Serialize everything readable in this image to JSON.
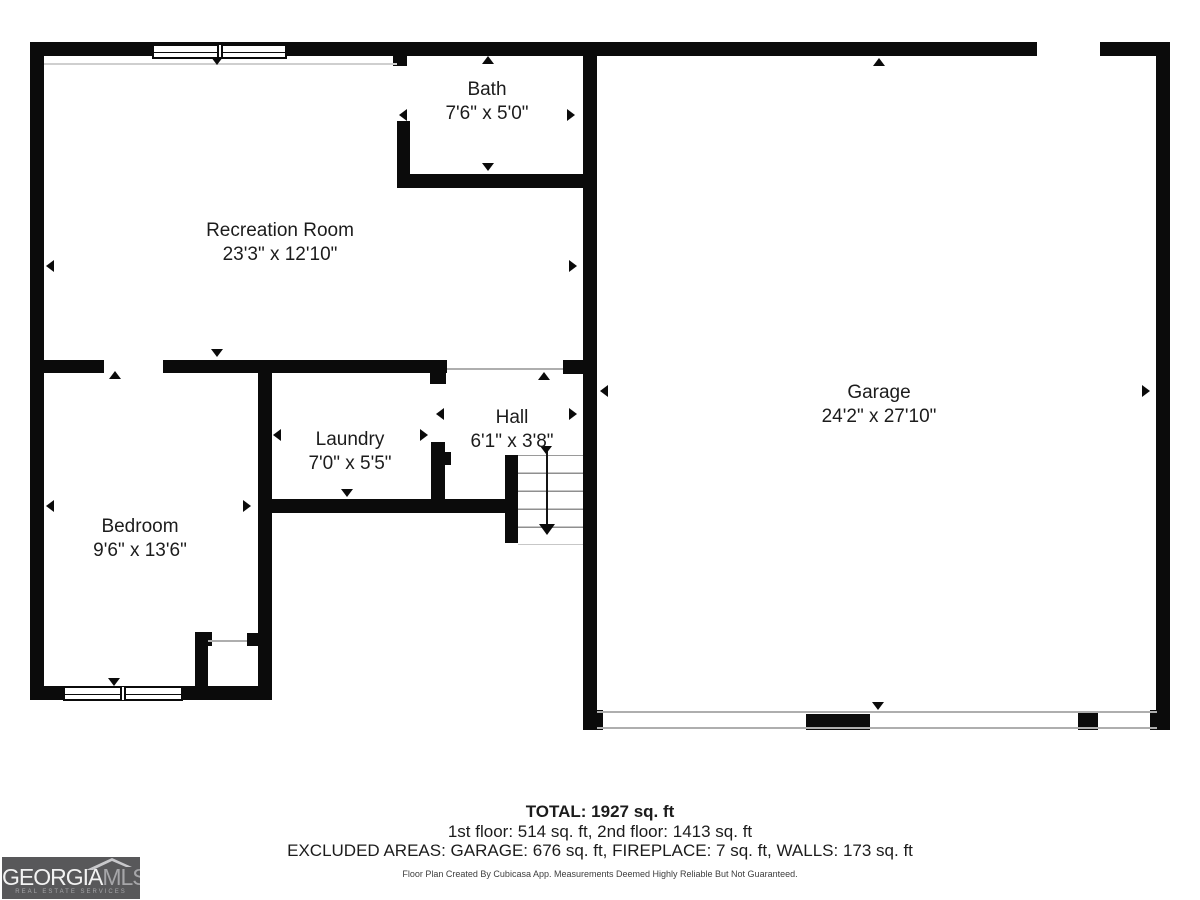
{
  "rooms": {
    "bath": {
      "name": "Bath",
      "dims": "7'6\" x 5'0\""
    },
    "recreation": {
      "name": "Recreation Room",
      "dims": "23'3\" x 12'10\""
    },
    "laundry": {
      "name": "Laundry",
      "dims": "7'0\" x 5'5\""
    },
    "hall": {
      "name": "Hall",
      "dims": "6'1\" x 3'8\""
    },
    "bedroom": {
      "name": "Bedroom",
      "dims": "9'6\" x 13'6\""
    },
    "garage": {
      "name": "Garage",
      "dims": "24'2\" x 27'10\""
    }
  },
  "summary": {
    "total": "TOTAL: 1927 sq. ft",
    "floors": "1st floor: 514 sq. ft, 2nd floor: 1413 sq. ft",
    "excluded": "EXCLUDED AREAS: GARAGE: 676 sq. ft, FIREPLACE: 7 sq. ft, WALLS: 173 sq. ft",
    "disclaimer": "Floor Plan Created By Cubicasa App. Measurements Deemed Highly Reliable But Not Guaranteed."
  },
  "logo": {
    "brand_primary": "GEORGIA",
    "brand_secondary": "MLS",
    "tagline": "REAL ESTATE SERVICES",
    "background_color": "#58585a"
  },
  "colors": {
    "wall": "#0b0b0b",
    "background": "#ffffff"
  }
}
